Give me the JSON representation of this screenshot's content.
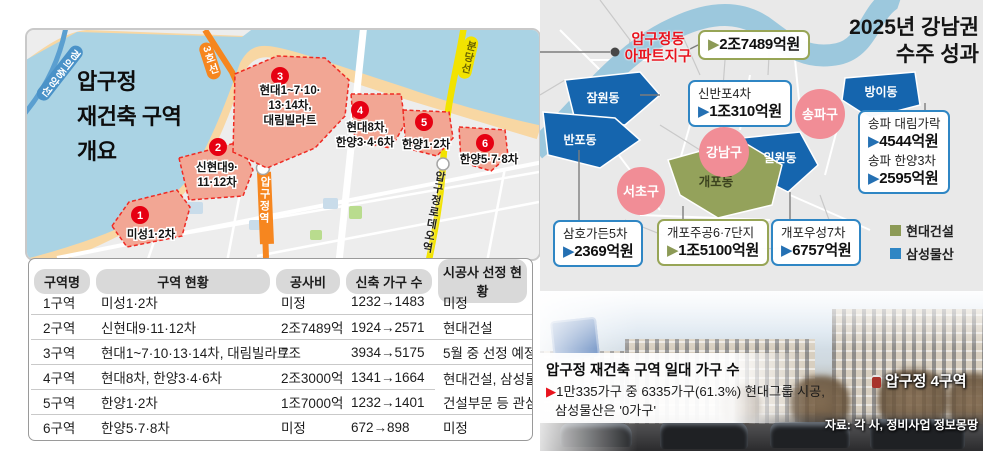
{
  "left_map": {
    "title_lines": [
      "압구정",
      "재건축 구역",
      "개요"
    ],
    "rail_labels": {
      "gyeongui": "경의중앙선",
      "line3": "3호선",
      "bundang": "분당선"
    },
    "stations": {
      "apgujeong": "압구정역",
      "rodeo": "압구정로데오역"
    },
    "districts": [
      {
        "no": "1",
        "lines": [
          "미성1·2차"
        ]
      },
      {
        "no": "2",
        "lines": [
          "신현대9·",
          "11·12차"
        ]
      },
      {
        "no": "3",
        "lines": [
          "현대1~7·10·",
          "13·14차,",
          "대림빌라트"
        ]
      },
      {
        "no": "4",
        "lines": [
          "현대8차,",
          "한양3·4·6차"
        ]
      },
      {
        "no": "5",
        "lines": [
          "한양1·2차"
        ]
      },
      {
        "no": "6",
        "lines": [
          "한양5·7·8차"
        ]
      }
    ]
  },
  "table": {
    "headers": [
      "구역명",
      "구역 현황",
      "공사비",
      "신축 가구 수",
      "시공사 선정 현황"
    ],
    "rows": [
      [
        "1구역",
        "미성1·2차",
        "미정",
        "1232→1483",
        "미정"
      ],
      [
        "2구역",
        "신현대9·11·12차",
        "2조7489억",
        "1924→2571",
        "현대건설"
      ],
      [
        "3구역",
        "현대1~7·10·13·14차, 대림빌라트",
        "7조",
        "3934→5175",
        "5월 중 선정 예정"
      ],
      [
        "4구역",
        "현대8차, 한양3·4·6차",
        "2조3000억",
        "1341→1664",
        "현대건설, 삼성물산"
      ],
      [
        "5구역",
        "한양1·2차",
        "1조7000억",
        "1232→1401",
        "건설부문 등 관심"
      ],
      [
        "6구역",
        "한양5·7·8차",
        "미정",
        "672→898",
        "미정"
      ]
    ]
  },
  "right_map": {
    "title_lines": [
      "2025년 강남권",
      "수주 성과"
    ],
    "apgujeong_label_lines": [
      "압구정동",
      "아파트지구"
    ],
    "regions": {
      "jamwon": "잠원동",
      "banpo": "반포동",
      "bangi": "방이동",
      "irwon": "일원동",
      "gaepo": "개포동"
    },
    "gu_circles": {
      "seocho": "서초구",
      "gangnam": "강남구",
      "songpa": "송파구"
    },
    "arrow": "▶",
    "boxes": {
      "apgujeong": {
        "value": "2조7489억원"
      },
      "sinbanpo": {
        "name": "신반포4차",
        "value": "1조310억원"
      },
      "songpa": {
        "name1": "송파 대림가락",
        "value1": "4544억원",
        "name2": "송파 한양3차",
        "value2": "2595억원"
      },
      "samho": {
        "name": "삼호가든5차",
        "value": "2369억원"
      },
      "gaepo_jugong": {
        "name": "개포주공6·7단지",
        "value": "1조5100억원"
      },
      "gaepo_wooseong": {
        "name": "개포우성7차",
        "value": "6757억원"
      }
    },
    "legend": [
      {
        "label": "현대건설",
        "color": "#8c9a56"
      },
      {
        "label": "삼성물산",
        "color": "#2f86c4"
      }
    ]
  },
  "photo": {
    "caption_title": "압구정 재건축 구역 일대 가구 수",
    "arrow": "▶",
    "caption_line1": "1만335가구 중 6335가구(61.3%) 현대그룹 시공,",
    "caption_line2": "삼성물산은 '0가구'",
    "area_label": "압구정 4구역",
    "source": "자료: 각 사, 정비사업 정보몽땅"
  },
  "colors": {
    "hyundai_green": "#8c9a56",
    "samsung_blue": "#2f86c4",
    "red_accent": "#e8131d",
    "line3_orange": "#f6861f",
    "bundang_yellow": "#f2e300",
    "district_pink": "#f18d96",
    "region_blue": "#1565ae",
    "gaepo_olive": "#94a25b"
  }
}
